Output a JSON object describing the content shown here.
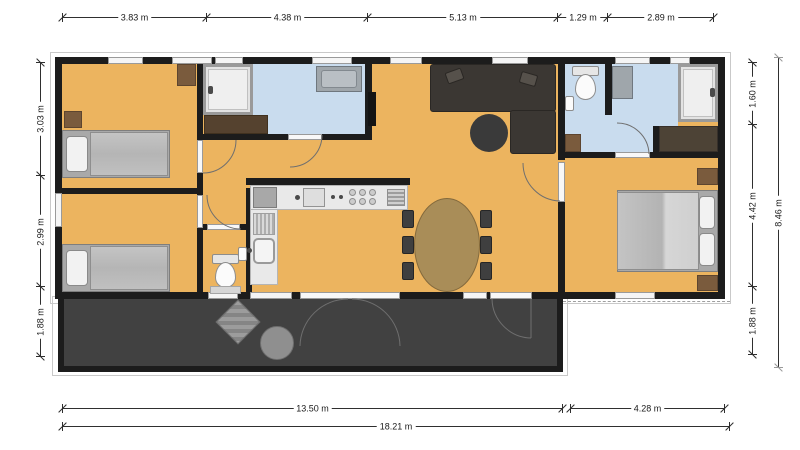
{
  "plan": {
    "type": "floorplan",
    "dimensions": {
      "top": [
        "3.83 m",
        "4.38 m",
        "5.13 m",
        "1.29 m",
        "2.89 m"
      ],
      "left": [
        "3.03 m",
        "2.99 m",
        "1.88 m"
      ],
      "right_inner": [
        "1.60 m",
        "4.42 m",
        "1.88 m"
      ],
      "right_outer": [
        "8.46 m"
      ],
      "bottom_inner": [
        "13.50 m",
        "4.28 m"
      ],
      "bottom_outer": [
        "18.21 m"
      ]
    },
    "colors": {
      "background": "#ffffff",
      "floor": "#ecb45f",
      "wet_room_floor": "#c9dcee",
      "walls": "#1c1c1c",
      "terrace": "#414141",
      "dimension_line": "#2f2f2f",
      "dimension_line_outer": "#9a9a9a",
      "wood_table": "#a98d58",
      "rug_brown": "#7a5b3d"
    }
  }
}
